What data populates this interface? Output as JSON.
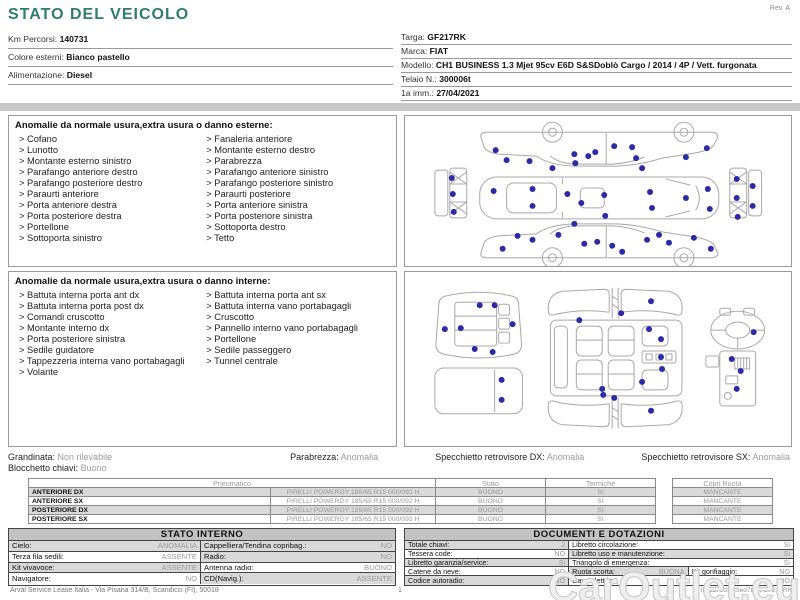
{
  "header": {
    "title": "STATO DEL VEICOLO",
    "rev": "Rev. A",
    "left_fields": [
      {
        "label": "Km Percorsi:",
        "value": "140731"
      },
      {
        "label": "Colore esterni:",
        "value": "Bianco pastello"
      },
      {
        "label": "Alimentazione:",
        "value": "Diesel"
      }
    ],
    "right_fields": [
      {
        "label": "Targa:",
        "value": "GF217RK"
      },
      {
        "label": "Marca:",
        "value": "FIAT"
      },
      {
        "label": "Modello:",
        "value": "CH1 BUSINESS 1.3 Mjet 95cv E6D S&SDoblò Cargo / 2014 / 4P / Vett. furgonata"
      },
      {
        "label": "Telaio N.:",
        "value": "300006t"
      },
      {
        "label": "1a imm.:",
        "value": "27/04/2021"
      }
    ]
  },
  "panels": {
    "exterior": {
      "title": "Anomalie da normale usura,extra usura o danno esterne:",
      "col1": [
        "Cofano",
        "Lunotto",
        "Montante esterno sinistro",
        "Parafango anteriore destro",
        "Parafango posteriore destro",
        "Paraurti anteriore",
        "Porta anteriore destra",
        "Porta posteriore destra",
        "Portellone",
        "Sottoporta sinistro"
      ],
      "col2": [
        "Fanaleria anteriore",
        "Montante esterno destro",
        "Parabrezza",
        "Parafango anteriore sinistro",
        "Parafango posteriore sinistro",
        "Paraurti posteriore",
        "Porta anteriore sinistra",
        "Porta posteriore sinistra",
        "Sottoporta destro",
        "Tetto"
      ]
    },
    "interior": {
      "title": "Anomalie da normale usura,extra usura o danno interne:",
      "col1": [
        "Battuta interna porta ant dx",
        "Battuta interna porta post dx",
        "Comandi cruscotto",
        "Montante interno dx",
        "Porta posteriore sinistra",
        "Sedile guidatore",
        "Tappezzeria interna vano portabagagli",
        "Volante"
      ],
      "col2": [
        "Battuta interna porta ant sx",
        "Battuta interna vano portabagagli",
        "Cruscotto",
        "Pannello interno vano portabagagli",
        "Portellone",
        "Sedile passeggero",
        "Tunnel centrale"
      ]
    }
  },
  "diagrams": {
    "dot_color": "#2b2ba6",
    "exterior_dots": [
      [
        91,
        34
      ],
      [
        102,
        44
      ],
      [
        125,
        45
      ],
      [
        148,
        52
      ],
      [
        170,
        38
      ],
      [
        171,
        47
      ],
      [
        184,
        40
      ],
      [
        191,
        36
      ],
      [
        210,
        30
      ],
      [
        228,
        31
      ],
      [
        232,
        42
      ],
      [
        238,
        52
      ],
      [
        282,
        41
      ],
      [
        303,
        32
      ],
      [
        47,
        62
      ],
      [
        48,
        78
      ],
      [
        49,
        96
      ],
      [
        89,
        75
      ],
      [
        128,
        73
      ],
      [
        128,
        90
      ],
      [
        163,
        78
      ],
      [
        177,
        87
      ],
      [
        200,
        79
      ],
      [
        201,
        100
      ],
      [
        246,
        76
      ],
      [
        248,
        92
      ],
      [
        282,
        82
      ],
      [
        304,
        73
      ],
      [
        306,
        93
      ],
      [
        333,
        63
      ],
      [
        349,
        70
      ],
      [
        333,
        82
      ],
      [
        349,
        90
      ],
      [
        334,
        101
      ],
      [
        98,
        133
      ],
      [
        113,
        120
      ],
      [
        128,
        124
      ],
      [
        154,
        119
      ],
      [
        170,
        108
      ],
      [
        180,
        128
      ],
      [
        193,
        126
      ],
      [
        208,
        130
      ],
      [
        218,
        136
      ],
      [
        243,
        124
      ],
      [
        255,
        119
      ],
      [
        265,
        127
      ],
      [
        290,
        122
      ],
      [
        307,
        133
      ]
    ],
    "interior_dots": [
      [
        75,
        33
      ],
      [
        90,
        33
      ],
      [
        40,
        57
      ],
      [
        56,
        56
      ],
      [
        108,
        52
      ],
      [
        70,
        77
      ],
      [
        88,
        80
      ],
      [
        97,
        108
      ],
      [
        97,
        128
      ],
      [
        175,
        48
      ],
      [
        217,
        41
      ],
      [
        247,
        29
      ],
      [
        245,
        57
      ],
      [
        257,
        67
      ],
      [
        257,
        85
      ],
      [
        258,
        97
      ],
      [
        238,
        110
      ],
      [
        198,
        117
      ],
      [
        199,
        123
      ],
      [
        210,
        126
      ],
      [
        247,
        139
      ],
      [
        350,
        60
      ],
      [
        328,
        87
      ],
      [
        337,
        99
      ],
      [
        333,
        117
      ]
    ]
  },
  "summary": {
    "grandinata_label": "Grandinata:",
    "grandinata_value": "Non rilevabile",
    "blocchetto_label": "Blocchetto chiavi:",
    "blocchetto_value": "Buono",
    "parabrezza_label": "Parabrezza:",
    "parabrezza_value": "Anomalia",
    "specchietto_dx_label": "Specchietto retrovisore DX:",
    "specchietto_dx_value": "Anomalia",
    "specchietto_sx_label": "Specchietto retrovisore SX:",
    "specchietto_sx_value": "Anomalia"
  },
  "tyres": {
    "headers": {
      "pneumatico": "Pneumatico",
      "stato": "Stato",
      "termiche": "Termiche",
      "copri_ruota": "Copri Ruota"
    },
    "rows": [
      {
        "position": "ANTERIORE DX",
        "tyre": "PIRELLI POWERGY 185/65 R15 000/092 H",
        "stato": "BUONO",
        "termiche": "SI",
        "copri_ruota": "MANCANTE"
      },
      {
        "position": "ANTERIORE SX",
        "tyre": "PIRELLI POWERGY 185/65 R15 000/092 H",
        "stato": "BUONO",
        "termiche": "SI",
        "copri_ruota": "MANCANTE"
      },
      {
        "position": "POSTERIORE DX",
        "tyre": "PIRELLI POWERGY 185/65 R15 000/092 H",
        "stato": "BUONO",
        "termiche": "SI",
        "copri_ruota": "MANCANTE"
      },
      {
        "position": "POSTERIORE SX",
        "tyre": "PIRELLI POWERGY 185/65 R15 000/092 H",
        "stato": "BUONO",
        "termiche": "SI",
        "copri_ruota": "MANCANTE"
      }
    ]
  },
  "stato_interno": {
    "title": "STATO INTERNO",
    "rows": [
      {
        "l1": "Cielo:",
        "v1": "ANOMALIA",
        "l2": "Cappelliera/Tendina copribag.:",
        "v2": "NO"
      },
      {
        "l1": "Terza fila sedili:",
        "v1": "ASSENTE",
        "l2": "Radio:",
        "v2": "NO"
      },
      {
        "l1": "Kit vivavoce:",
        "v1": "ASSENTE",
        "l2": "Antenna radio:",
        "v2": "BUONO"
      },
      {
        "l1": "Navigatore:",
        "v1": "NO",
        "l2": "CD(Navig.):",
        "v2": "ASSENTE"
      }
    ]
  },
  "documenti": {
    "title": "DOCUMENTI E DOTAZIONI",
    "rows": [
      {
        "l1": "Totale chiavi:",
        "v1": "2",
        "l2": "Libretto circolazione:",
        "v2": "Si"
      },
      {
        "l1": "Tessera code:",
        "v1": "NO",
        "l2": "Libretto uso e manutenzione:",
        "v2": "Si"
      },
      {
        "l1": "Libretto garanzia/service:",
        "v1": "Si",
        "l2": "Triangolo di emergenza:",
        "v2": "Si"
      },
      {
        "l1": "Catene da neve:",
        "v1": "NO",
        "l2": "Ruota scorta:",
        "v2": "BUONA",
        "l3": "Kit gonfiaggio:",
        "v3": "NO"
      },
      {
        "l1": "Codice autoradio:",
        "v1": "NO",
        "l2": "Cavo elettrico:",
        "v2": "NO"
      }
    ]
  },
  "footer": {
    "left": "Arval Service Lease Italia - Via Pisana 314/B, Scandicci (FI), 50018",
    "page": "1",
    "right": "ID 1278d3.25ed7b3 , GF217RK"
  },
  "watermark": "CarOutlet.eu"
}
